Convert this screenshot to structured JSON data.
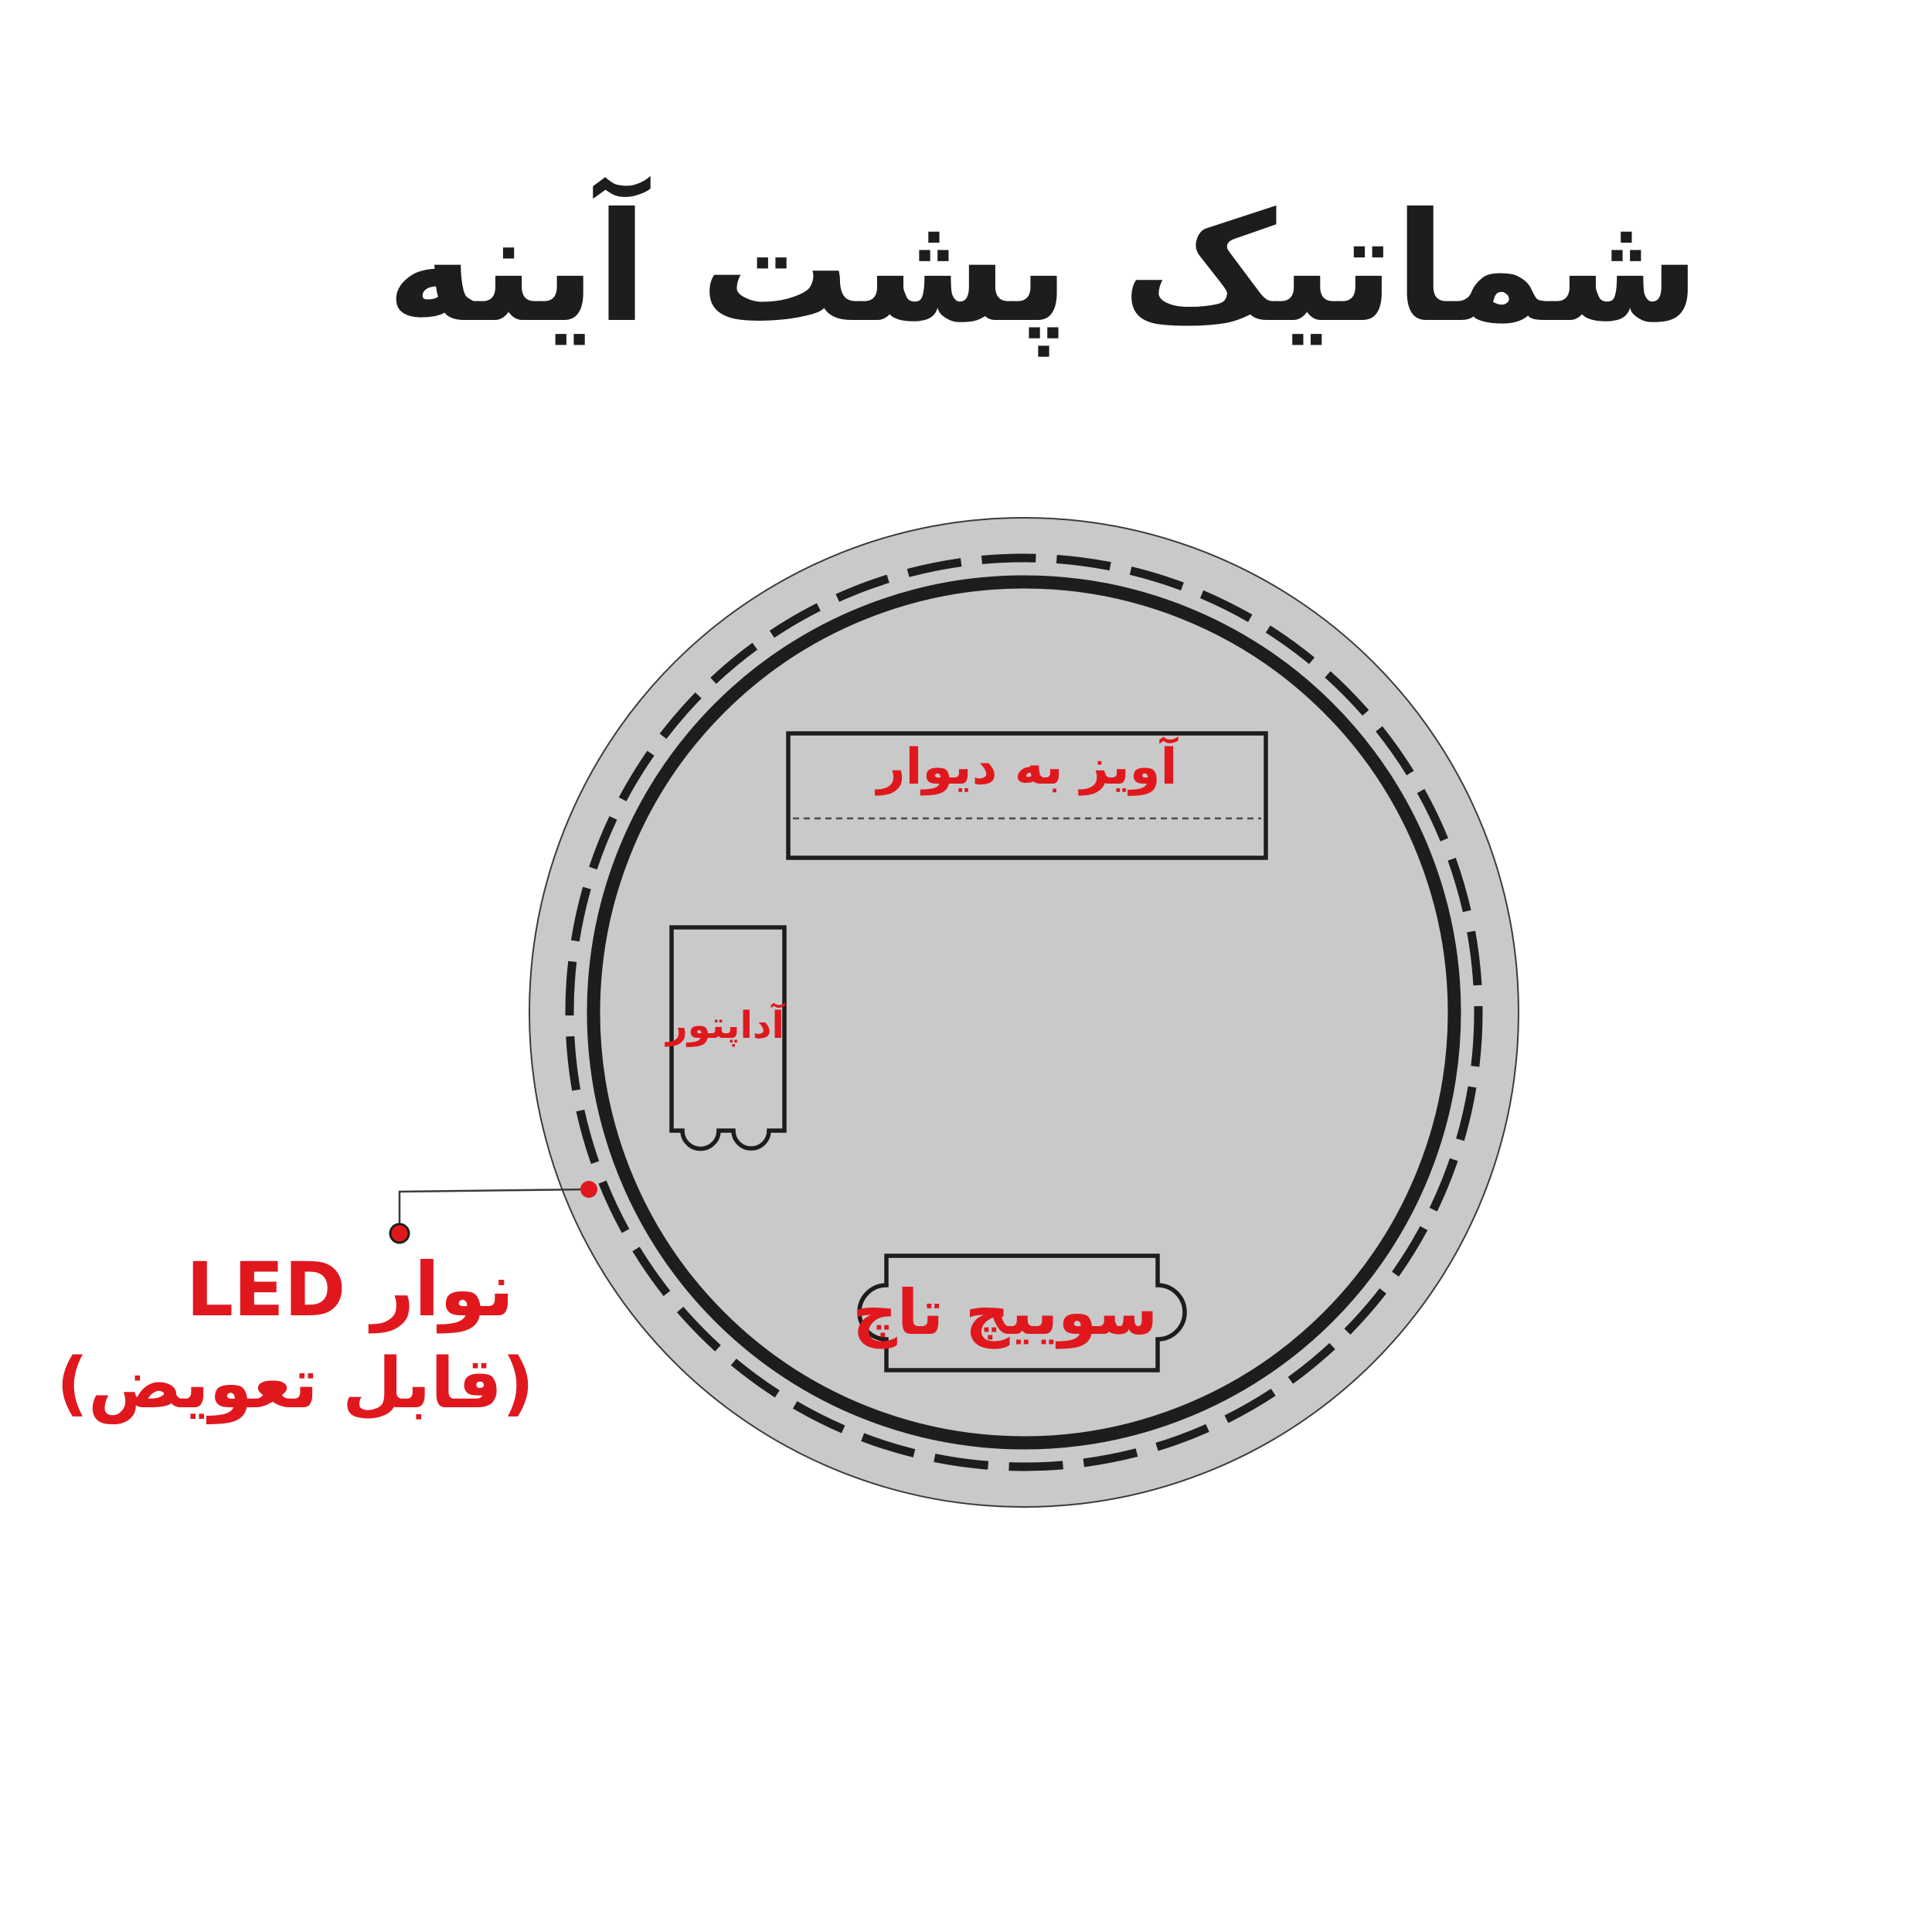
{
  "title": "شماتیک پشت آینه",
  "diagram": {
    "hanger_label": "آویز به دیوار",
    "adapter_label": "آداپتور",
    "switch_label": "سوییچ تاچ",
    "led_label_line1": "نوار LED",
    "led_label_line2": "(قابل تعویض)"
  },
  "colors": {
    "accent-red": "#e0181e",
    "mirror-gray": "#c9c9c9",
    "ink-black": "#1d1d1b",
    "outline-gray": "#3b3b39",
    "page-bg": "#ffffff"
  }
}
